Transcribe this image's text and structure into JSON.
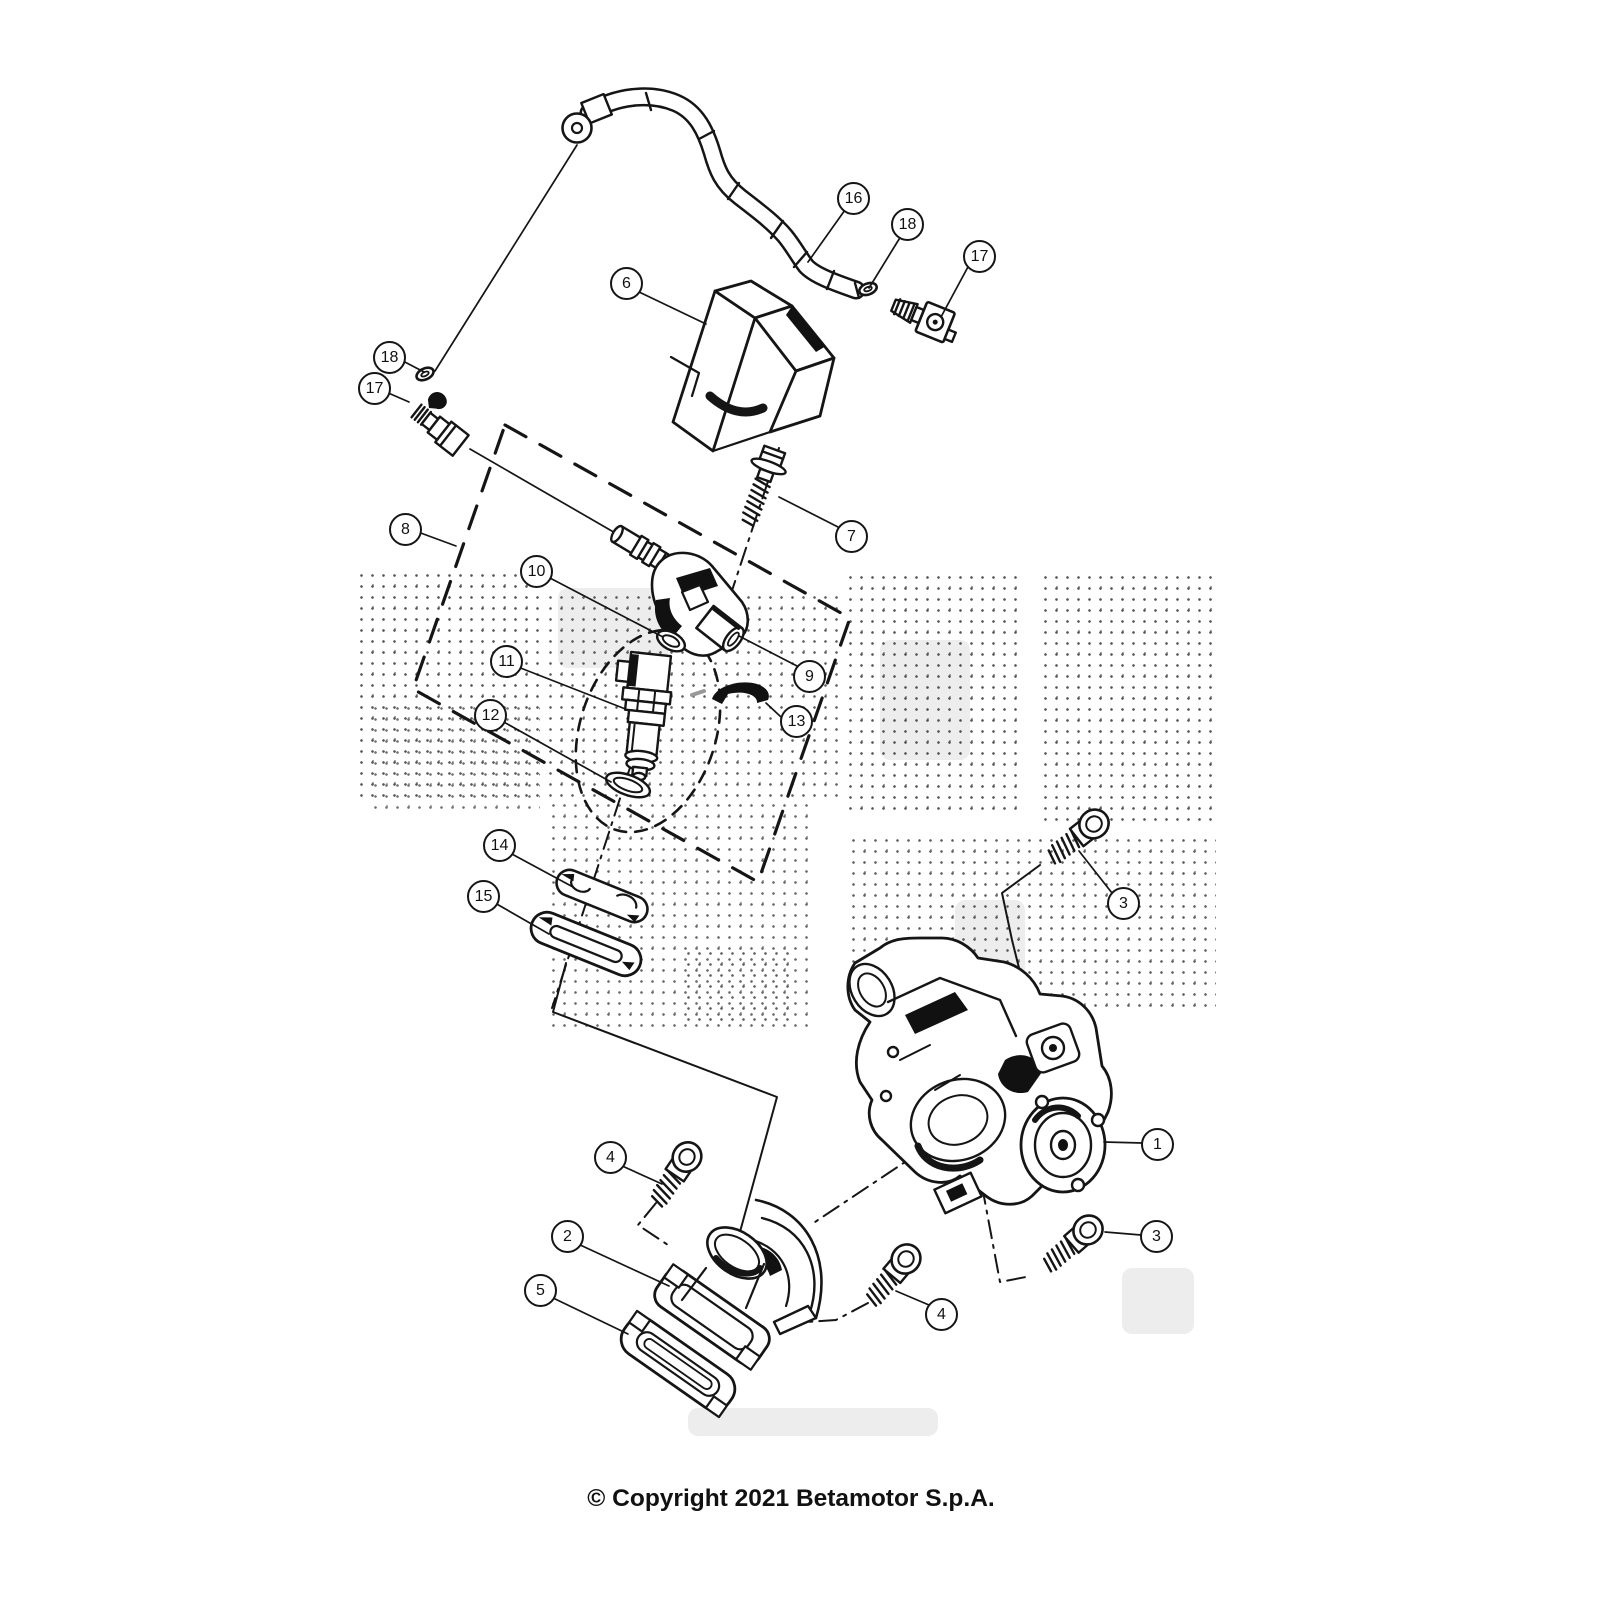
{
  "diagram": {
    "copyright": "© Copyright 2021 Betamotor S.p.A.",
    "callouts": [
      {
        "label": "16"
      },
      {
        "label": "18"
      },
      {
        "label": "17"
      },
      {
        "label": "6"
      },
      {
        "label": "18"
      },
      {
        "label": "17"
      },
      {
        "label": "8"
      },
      {
        "label": "7"
      },
      {
        "label": "10"
      },
      {
        "label": "9"
      },
      {
        "label": "11"
      },
      {
        "label": "13"
      },
      {
        "label": "12"
      },
      {
        "label": "14"
      },
      {
        "label": "15"
      },
      {
        "label": "3"
      },
      {
        "label": "1"
      },
      {
        "label": "3"
      },
      {
        "label": "4"
      },
      {
        "label": "2"
      },
      {
        "label": "4"
      },
      {
        "label": "5"
      }
    ]
  }
}
